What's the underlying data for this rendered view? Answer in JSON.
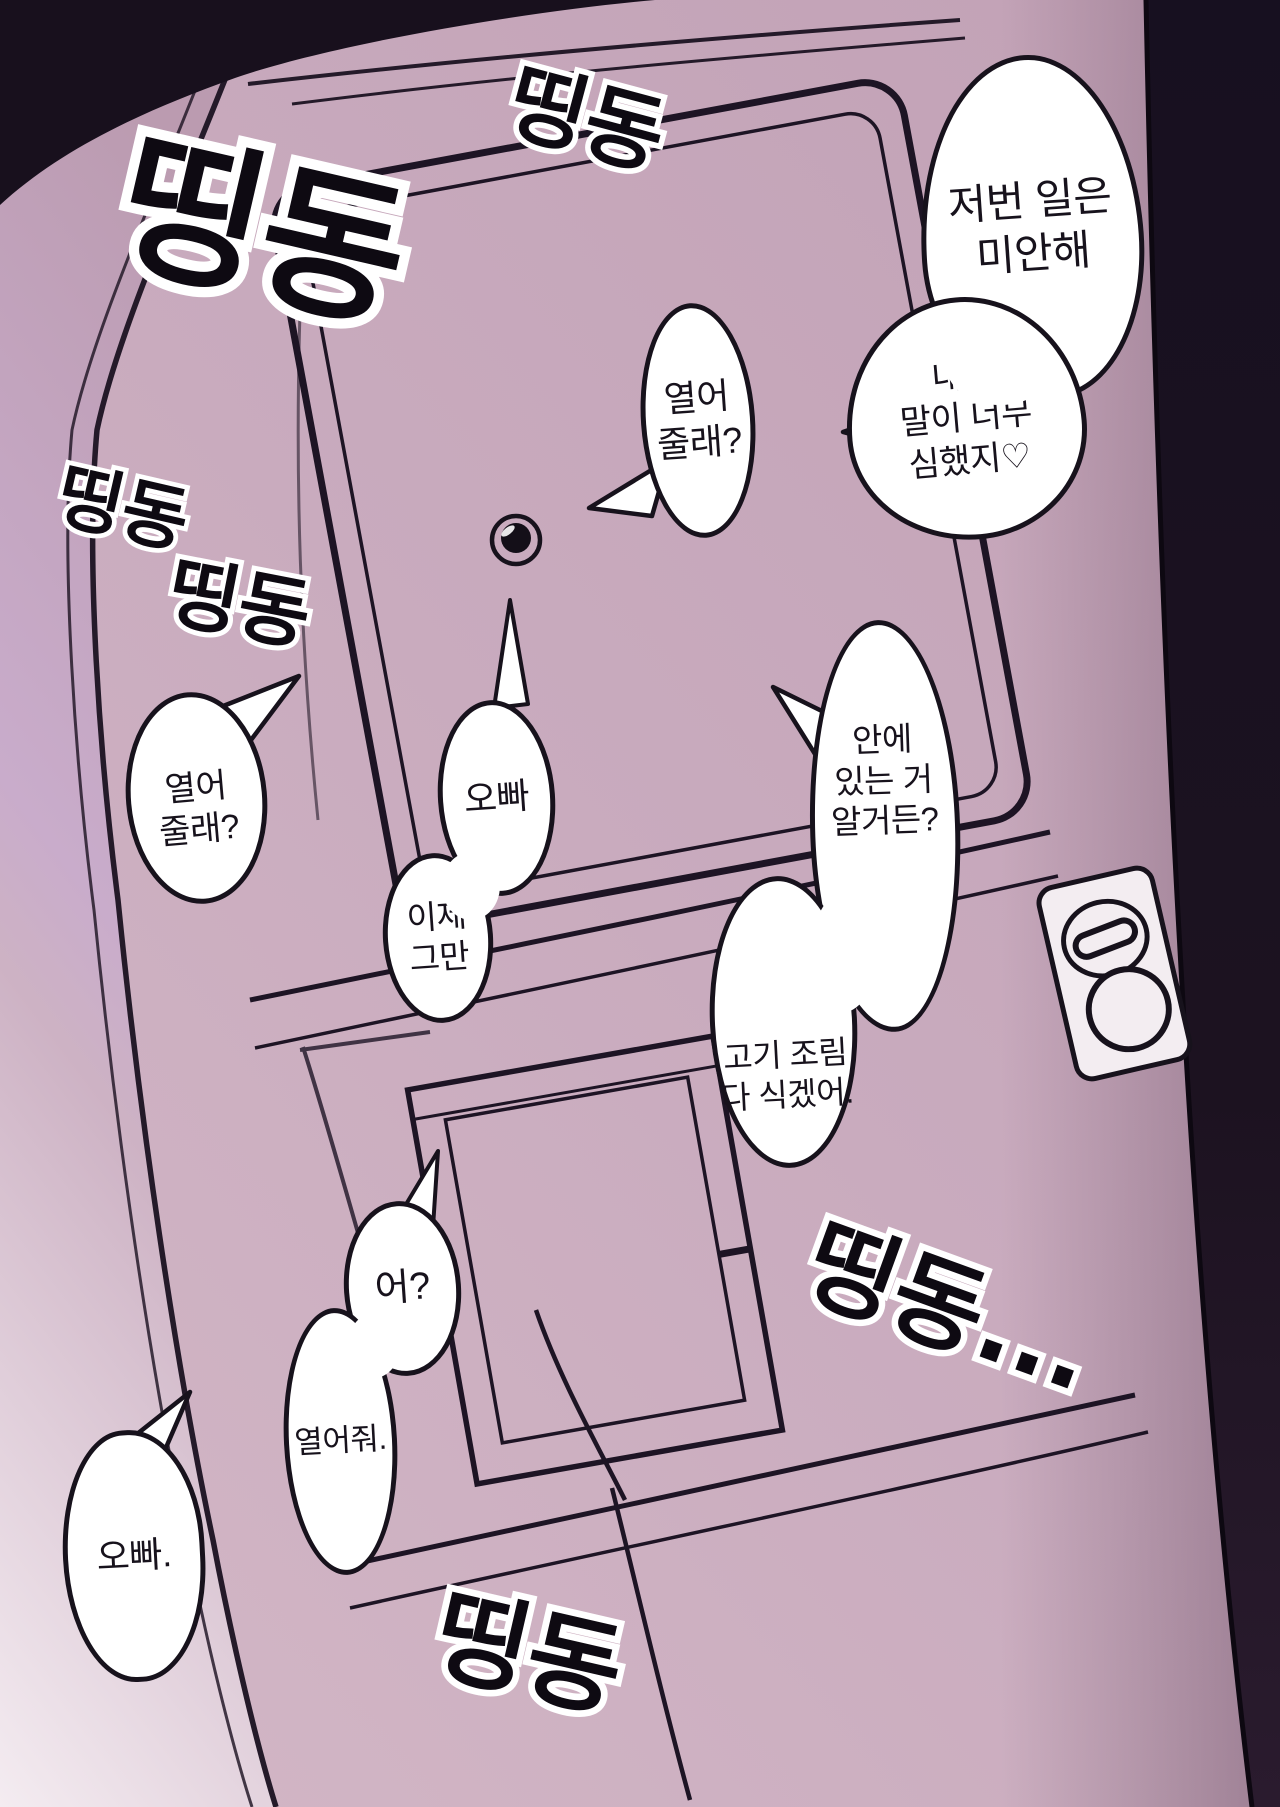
{
  "page": {
    "kind": "comic-page",
    "language": "ko",
    "scene": "apartment front door seen at an angle while the doorbell is rung repeatedly"
  },
  "palette": {
    "door_face": "#c9abbe",
    "door_edge_dark": "#1c1220",
    "left_frame_light": "#f2e9ef",
    "outline": "#17121c",
    "bubble_fill": "#ffffff"
  },
  "sound_effects": [
    {
      "id": "top-left",
      "text": "띵동"
    },
    {
      "id": "top-center",
      "text": "띵동"
    },
    {
      "id": "mid-left-upper",
      "text": "띵동"
    },
    {
      "id": "mid-left-lower",
      "text": "띵동"
    },
    {
      "id": "bottom-center",
      "text": "띵동"
    },
    {
      "id": "bottom-right",
      "text": "띵동..."
    }
  ],
  "speech_bubbles": [
    {
      "id": "apology-upper",
      "lines": [
        "저번 일은",
        "미안해"
      ]
    },
    {
      "id": "apology-lower",
      "lines": [
        "내가",
        "말이 너무",
        "심했지♡"
      ]
    },
    {
      "id": "open-request-center",
      "lines": [
        "열어",
        "줄래?"
      ]
    },
    {
      "id": "open-request-left",
      "lines": [
        "열어",
        "줄래?"
      ]
    },
    {
      "id": "oppa-call",
      "lines": [
        "오빠"
      ]
    },
    {
      "id": "now-stop",
      "lines": [
        "이제",
        "그만"
      ]
    },
    {
      "id": "know-inside",
      "lines": [
        "안에",
        "있는 거",
        "알거든?"
      ]
    },
    {
      "id": "food-cold",
      "lines": [
        "고기 조림",
        "다 식겠어."
      ]
    },
    {
      "id": "huh",
      "lines": [
        "어?"
      ]
    },
    {
      "id": "open-up",
      "lines": [
        "열어줘."
      ]
    },
    {
      "id": "oppa-final",
      "lines": [
        "오빠."
      ]
    }
  ]
}
